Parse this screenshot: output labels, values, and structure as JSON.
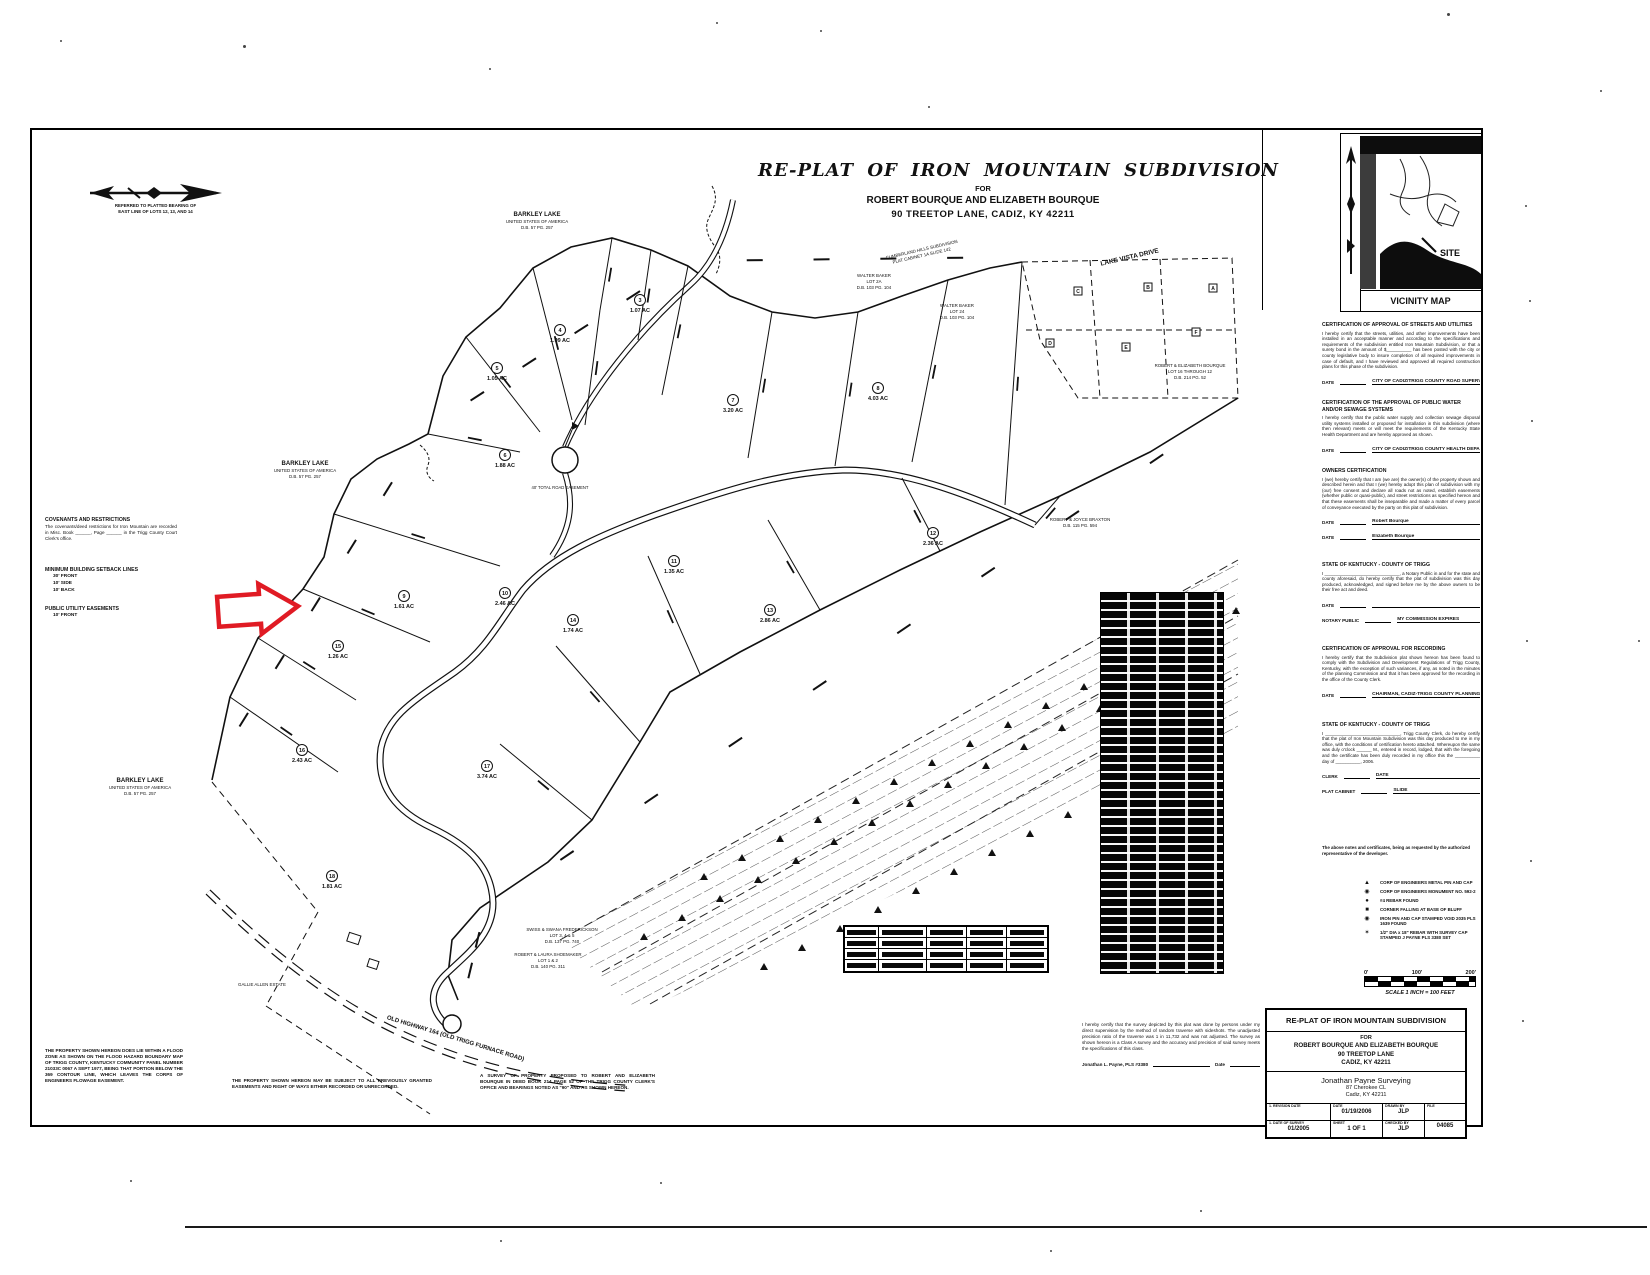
{
  "header": {
    "title": "RE-PLAT OF IRON MOUNTAIN SUBDIVISION",
    "for_line": "FOR",
    "owner_line": "ROBERT BOURQUE AND ELIZABETH BOURQUE",
    "address_line": "90 TREETOP LANE, CADIZ, KY  42211"
  },
  "north_arrow_note": {
    "line1": "REFERRED TO PLATTED BEARING OF",
    "line2": "EAST LINE OF LOTS 12, 13, AND 14"
  },
  "vicinity": {
    "site_label": "SITE",
    "caption": "VICINITY MAP"
  },
  "left_notes": {
    "covenants_heading": "COVENANTS AND RESTRICTIONS",
    "covenants_body": "The covenants/deed restrictions for Iron Mountain are recorded in Misc. Book ______,  Page ______  in the Trigg County Court Clerk's office.",
    "setback_heading": "MINIMUM BUILDING SETBACK LINES",
    "setback_lines": [
      "30' FRONT",
      "10' SIDE",
      "10' BACK"
    ],
    "utility_heading": "PUBLIC UTILITY EASEMENTS",
    "utility_lines": [
      "10' FRONT"
    ],
    "flood_note": "THE PROPERTY SHOWN HEREON DOES LIE WITHIN A FLOOD ZONE AS SHOWN ON THE FLOOD HAZARD BOUNDARY MAP OF TRIGG COUNTY, KENTUCKY COMMUNITY PANEL NUMBER 21033C 0067 A SEPT 1977, BEING THAT PORTION BELOW THE 369 CONTOUR LINE, WHICH LEAVES THE CORPS OF ENGINEERS FLOWAGE EASEMENT."
  },
  "bottom_notes": {
    "subject_note": "THE PROPERTY SHOWN HEREON MAY BE SUBJECT TO ALL PREVIOUSLY GRANTED EASEMENTS AND RIGHT OF WAYS EITHER RECORDED OR UNRECORDED.",
    "survey_note": "A SURVEY OF PROPERTY PROPOSED TO ROBERT AND ELIZABETH BOURQUE IN DEED BOOK 214 PAGE 52 OF THE TRIGG COUNTY CLERK'S OFFICE AND BEARINGS NOTED AS \"90\" AND AS SHOWN HEREON.",
    "surveyor_cert": "I hereby certify that the survey depicted by this plat was done by persons under my direct supervision by the method of random traverse with sideshots. The unadjusted precision ratio of the traverse was 1 in 11,732 and was not adjusted. The survey as shown hereon is a Class A survey and the accuracy and precision of said survey meets the specifications of this class.",
    "surveyor_sig": "Jonathan L. Payne,  PLS #3380",
    "surveyor_date_label": "Date"
  },
  "certifications": [
    {
      "heading": "CERTIFICATION OF APPROVAL OF STREETS AND UTILITIES",
      "body": "I hereby certify that the streets, utilities, and other improvements have been installed in an acceptable manner and according to the specifications and requirements of the subdivision entitled Iron Mountain Subdivision, or that a surety bond in the amount of $__________ has been posted with the city or county legislative body to insure completion of all required improvements in case of default, and I have reviewed and approved all required construction plans for this phase of the subdivision.",
      "sig": [
        {
          "label": "DATE",
          "title": "CITY OF CADIZ/TRIGG COUNTY ROAD SUPERVISOR OR APPROPRIATE AGENT"
        }
      ]
    },
    {
      "heading": "CERTIFICATION OF THE APPROVAL OF PUBLIC WATER AND/OR SEWAGE SYSTEMS",
      "body": "I hereby certify that the public water supply and collection sewage disposal utility systems installed or proposed for installation in this subdivision (where then relevant) meets or will meet the requirements of the Kentucky State Health Department and are hereby approved as shown.",
      "sig": [
        {
          "label": "DATE",
          "title": "CITY OF CADIZ/TRIGG COUNTY HEALTH DEPARTMENT OR APPROPRIATE AGENT"
        }
      ]
    },
    {
      "heading": "OWNERS CERTIFICATION",
      "body": "I (we) hereby certify that I am (we are) the owner(s) of the property shown and described herein and that I (we) hereby adopt this plan of subdivision with my (our) free consent and declare all roads not as noted, establish easements (whether public or quasi-public), and street restrictions as specified hereon and that these easements shall be inseparable and made a matter of every parcel of conveyance executed by the party on this plat of subdivision.",
      "sig": [
        {
          "label": "DATE",
          "title": "Robert Bourque"
        },
        {
          "label": "DATE",
          "title": "Elizabeth Bourque"
        }
      ]
    },
    {
      "heading": "STATE OF KENTUCKY - COUNTY OF TRIGG",
      "body": "I ______________________________, a Notary Public in and for the state and county aforesaid, do hereby certify that the plat of subdivision was this day produced, acknowledged, and signed before me by the above owners to be their free act and deed.",
      "sig": [
        {
          "label": "DATE",
          "title": ""
        },
        {
          "label": "NOTARY PUBLIC",
          "title": "MY COMMISSION EXPIRES"
        }
      ]
    },
    {
      "heading": "CERTIFICATION OF APPROVAL FOR RECORDING",
      "body": "I hereby certify that the Subdivision plat shown hereon has been found to comply with the Subdivision and Development Regulations of Trigg County, Kentucky, with the exception of such variances, if any, as noted in the minutes of the planning Commission and that it has been approved for the recording in the office of the County Clerk.",
      "sig": [
        {
          "label": "DATE",
          "title": "CHAIRMAN, CADIZ-TRIGG COUNTY PLANNING COMMISSION"
        }
      ]
    },
    {
      "heading": "STATE OF KENTUCKY - COUNTY OF TRIGG",
      "body": "I ______________________________, Trigg County Clerk, do hereby certify that the plat of Iron Mountain Subdivision was this day produced to me in my office, with the conditions of certification hereto attached. Whereupon the same was duly o'clock ______ M., entered in record, lodged, that with the foregoing and the certificate has been duly recorded in my office this the __________ day of __________, 2006.",
      "sig": [
        {
          "label": "CLERK",
          "title": "DATE"
        },
        {
          "label": "PLAT CABINET",
          "title": "SLIDE"
        }
      ]
    }
  ],
  "cert_footer": "The above notes and certificates, being as requested by the authorized representative of the developer.",
  "legend": {
    "items": [
      {
        "icon": "triangle-icon",
        "glyph": "▲",
        "text": "CORP OF ENGINEERS METAL PIN AND CAP"
      },
      {
        "icon": "circled-dot-icon",
        "glyph": "◉",
        "text": "CORP OF ENGINEERS MONUMENT NO. 592-2"
      },
      {
        "icon": "dot-icon",
        "glyph": "●",
        "text": "#4 REBAR FOUND"
      },
      {
        "icon": "square-icon",
        "glyph": "■",
        "text": "CORNER FALLING AT BASE OF BLUFF"
      },
      {
        "icon": "circled-dot-icon",
        "glyph": "◉",
        "text": "IRON PIN AND CAP STAMPED VOID 2035 PLS 1639 FOUND"
      },
      {
        "icon": "star-icon",
        "glyph": "✶",
        "text": "1/2\" DIA x 18\" REBAR WITH SURVEY CAP STAMPED J PAYNE PLS 3380 SET"
      }
    ]
  },
  "scale_bar": {
    "ticks": [
      "0'",
      "100'",
      "200'"
    ],
    "caption": "SCALE 1 INCH = 100 FEET"
  },
  "title_block": {
    "title": "RE-PLAT OF IRON MOUNTAIN SUBDIVISION",
    "for_line": "FOR",
    "owner_line": "ROBERT BOURQUE AND ELIZABETH BOURQUE",
    "address1": "90 TREETOP LANE",
    "address2": "CADIZ, KY  42211",
    "firm": "Jonathan Payne Surveying",
    "firm_addr1": "87 Cherokee CL",
    "firm_addr2": "Cadiz, KY  42211",
    "row1": {
      "c1_label": "1. REVISION DATE",
      "c1_value": "",
      "c2_label": "DATE",
      "c2_value": "01/19/2006",
      "c3_label": "DRAWN BY",
      "c3_value": "JLP",
      "c4_label": "FILE",
      "c4_value": ""
    },
    "row2": {
      "c1_label": "1. DATE OF SURVEY",
      "c1_value": "01/2005",
      "c2_label": "SHEET",
      "c2_value": "1 OF 1",
      "c3_label": "CHECKED BY",
      "c3_value": "JLP",
      "c4_label": "",
      "c4_value": "04085"
    }
  },
  "map": {
    "lots": [
      {
        "num": "5",
        "acres": "1.05 AC",
        "x": 497,
        "y": 380
      },
      {
        "num": "4",
        "acres": "1.09 AC",
        "x": 560,
        "y": 342
      },
      {
        "num": "3",
        "acres": "1.07 AC",
        "x": 640,
        "y": 312
      },
      {
        "num": "6",
        "acres": "1.88 AC",
        "x": 505,
        "y": 467
      },
      {
        "num": "7",
        "acres": "3.20 AC",
        "x": 733,
        "y": 412
      },
      {
        "num": "8",
        "acres": "4.03 AC",
        "x": 878,
        "y": 400
      },
      {
        "num": "9",
        "acres": "1.61 AC",
        "x": 404,
        "y": 608
      },
      {
        "num": "10",
        "acres": "2.46 AC",
        "x": 505,
        "y": 605
      },
      {
        "num": "11",
        "acres": "1.35 AC",
        "x": 674,
        "y": 573
      },
      {
        "num": "12",
        "acres": "2.36 AC",
        "x": 933,
        "y": 545
      },
      {
        "num": "13",
        "acres": "2.86 AC",
        "x": 770,
        "y": 622
      },
      {
        "num": "14",
        "acres": "1.74 AC",
        "x": 573,
        "y": 632
      },
      {
        "num": "15",
        "acres": "1.26 AC",
        "x": 338,
        "y": 658
      },
      {
        "num": "16",
        "acres": "2.43 AC",
        "x": 302,
        "y": 762
      },
      {
        "num": "17",
        "acres": "3.74 AC",
        "x": 487,
        "y": 778
      },
      {
        "num": "18",
        "acres": "1.81 AC",
        "x": 332,
        "y": 888
      }
    ],
    "letters": [
      {
        "t": "A",
        "x": 1213,
        "y": 288
      },
      {
        "t": "B",
        "x": 1148,
        "y": 287
      },
      {
        "t": "C",
        "x": 1078,
        "y": 291
      },
      {
        "t": "D",
        "x": 1050,
        "y": 343
      },
      {
        "t": "E",
        "x": 1126,
        "y": 347
      },
      {
        "t": "F",
        "x": 1196,
        "y": 332
      }
    ],
    "labels": [
      {
        "t": "BARKLEY LAKE",
        "x": 537,
        "y": 216,
        "r": 0,
        "s": 6,
        "b": 1
      },
      {
        "t": "UNITED STATES OF AMERICA",
        "x": 537,
        "y": 223,
        "r": 0,
        "s": 4.4
      },
      {
        "t": "D.B. 57 PG. 257",
        "x": 537,
        "y": 229,
        "r": 0,
        "s": 4.4
      },
      {
        "t": "BARKLEY LAKE",
        "x": 305,
        "y": 465,
        "r": 0,
        "s": 6,
        "b": 1
      },
      {
        "t": "UNITED STATES OF AMERICA",
        "x": 305,
        "y": 472,
        "r": 0,
        "s": 4.4
      },
      {
        "t": "D.B. 57 PG. 257",
        "x": 305,
        "y": 478,
        "r": 0,
        "s": 4.4
      },
      {
        "t": "BARKLEY LAKE",
        "x": 140,
        "y": 782,
        "r": 0,
        "s": 6,
        "b": 1
      },
      {
        "t": "UNITED STATES OF AMERICA",
        "x": 140,
        "y": 789,
        "r": 0,
        "s": 4.4
      },
      {
        "t": "D.B. 57 PG. 257",
        "x": 140,
        "y": 795,
        "r": 0,
        "s": 4.4
      },
      {
        "t": "LAKE VISTA DRIVE",
        "x": 1130,
        "y": 259,
        "r": -13,
        "s": 6.5,
        "b": 1
      },
      {
        "t": "CUMBERLAND HILLS SUBDIVISION",
        "x": 922,
        "y": 251,
        "r": -13,
        "s": 4.4
      },
      {
        "t": "PLAT CABINET 1A SLIDE 142",
        "x": 922,
        "y": 257,
        "r": -13,
        "s": 4.4
      },
      {
        "t": "WALTER BAKER",
        "x": 874,
        "y": 277,
        "r": 0,
        "s": 4.4
      },
      {
        "t": "LOT 2A",
        "x": 874,
        "y": 283,
        "r": 0,
        "s": 4.4
      },
      {
        "t": "D.B. 103 PG. 104",
        "x": 874,
        "y": 289,
        "r": 0,
        "s": 4.4
      },
      {
        "t": "WALTER BAKER",
        "x": 957,
        "y": 307,
        "r": 0,
        "s": 4.4
      },
      {
        "t": "LOT 24",
        "x": 957,
        "y": 313,
        "r": 0,
        "s": 4.4
      },
      {
        "t": "D.B. 103 PG. 104",
        "x": 957,
        "y": 319,
        "r": 0,
        "s": 4.4
      },
      {
        "t": "ROBERT & ELIZABETH BOURQUE",
        "x": 1190,
        "y": 367,
        "r": 0,
        "s": 4.4
      },
      {
        "t": "LOT 16 THROUGH 12",
        "x": 1190,
        "y": 373,
        "r": 0,
        "s": 4.4
      },
      {
        "t": "D.B. 214 PG. 52",
        "x": 1190,
        "y": 379,
        "r": 0,
        "s": 4.4
      },
      {
        "t": "ROBERT & JOYCE BRAXTON",
        "x": 1080,
        "y": 521,
        "r": 0,
        "s": 4.4
      },
      {
        "t": "D.B. 115 PG. 594",
        "x": 1080,
        "y": 527,
        "r": 0,
        "s": 4.4
      },
      {
        "t": "40' TOTAL ROAD EASEMENT",
        "x": 560,
        "y": 489,
        "r": 0,
        "s": 4.2
      },
      {
        "t": "GALLIE ALLEN ESTATE",
        "x": 262,
        "y": 986,
        "r": 0,
        "s": 4.4
      },
      {
        "t": "SWISS & SWANA FREDERICKSON",
        "x": 562,
        "y": 931,
        "r": 0,
        "s": 4.4
      },
      {
        "t": "LOT 3, 4 & 5",
        "x": 562,
        "y": 937,
        "r": 0,
        "s": 4.4
      },
      {
        "t": "D.B. 137 PG. 740",
        "x": 562,
        "y": 943,
        "r": 0,
        "s": 4.4
      },
      {
        "t": "ROBERT & LAURA SHOEMAKER",
        "x": 548,
        "y": 956,
        "r": 0,
        "s": 4.4
      },
      {
        "t": "LOT 1 & 2",
        "x": 548,
        "y": 962,
        "r": 0,
        "s": 4.4
      },
      {
        "t": "D.B. 140 PG. 311",
        "x": 548,
        "y": 968,
        "r": 0,
        "s": 4.4
      },
      {
        "t": "OLD HIGHWAY 164 (OLD TRIGG FURNACE ROAD)",
        "x": 455,
        "y": 1040,
        "r": 17,
        "s": 6,
        "b": 1
      }
    ]
  }
}
